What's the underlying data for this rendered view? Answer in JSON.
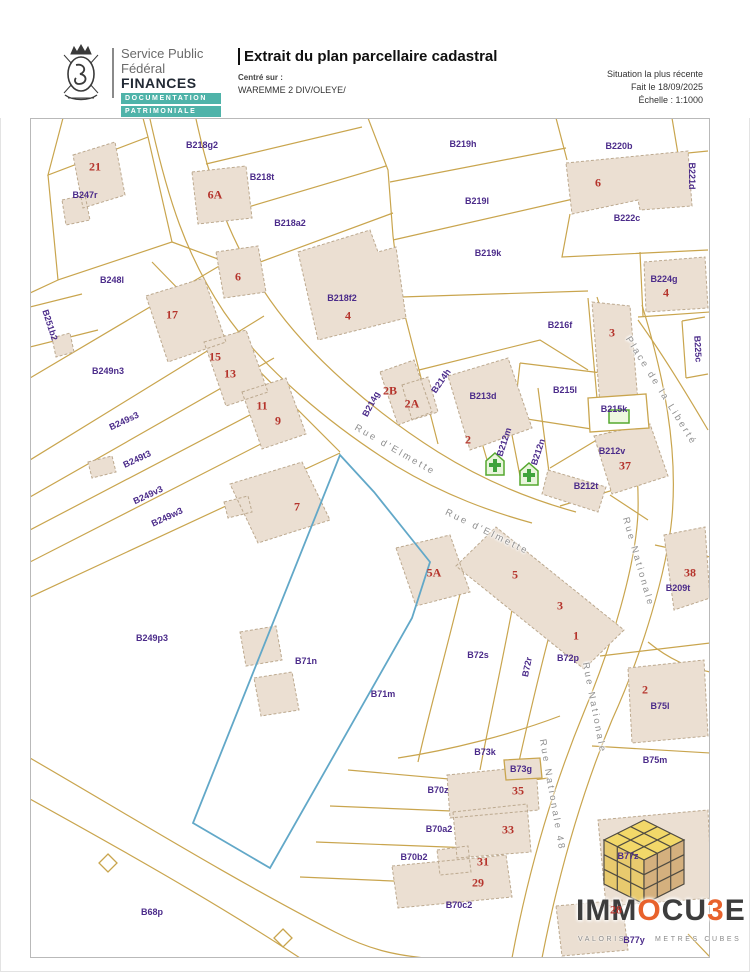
{
  "header": {
    "logo": {
      "emblem": "belgian-coat-of-arms",
      "org_line1": "Service Public",
      "org_line2": "Fédéral",
      "org_line3": "FINANCES",
      "badges": [
        "DOCUMENTATION",
        "PATRIMONIALE"
      ]
    },
    "title": "Extrait du plan parcellaire cadastral",
    "centered_label": "Centré sur :",
    "centered_value": "WAREMME 2 DIV/OLEYE/",
    "meta_lines": [
      "Situation la plus récente",
      "Fait le 18/09/2025",
      "Échelle : 1:1000"
    ]
  },
  "map": {
    "highlighted_parcel": "B71n",
    "colors": {
      "parcel_line": "#C9A54E",
      "building_fill": "#EBDFD2",
      "building_stroke": "#BCA98F",
      "parcel_label": "#4B2B8A",
      "house_number": "#B5342C",
      "street_label": "#8F8F8F",
      "highlight_line": "#62A8C8",
      "poi_green": "#3FA33C",
      "badge_teal": "#4FB3A9"
    },
    "parcel_labels": [
      {
        "text": "B247r",
        "x": 85,
        "y": 195
      },
      {
        "text": "B218g2",
        "x": 202,
        "y": 145
      },
      {
        "text": "B218t",
        "x": 262,
        "y": 177
      },
      {
        "text": "B218a2",
        "x": 290,
        "y": 223
      },
      {
        "text": "B218f2",
        "x": 342,
        "y": 298
      },
      {
        "text": "B219h",
        "x": 463,
        "y": 144
      },
      {
        "text": "B219l",
        "x": 477,
        "y": 201
      },
      {
        "text": "B219k",
        "x": 488,
        "y": 253
      },
      {
        "text": "B220b",
        "x": 619,
        "y": 146
      },
      {
        "text": "B221d",
        "x": 692,
        "y": 176,
        "rot": 90
      },
      {
        "text": "B222c",
        "x": 627,
        "y": 218
      },
      {
        "text": "B224g",
        "x": 664,
        "y": 279
      },
      {
        "text": "B225c",
        "x": 698,
        "y": 349,
        "rot": 87
      },
      {
        "text": "B248l",
        "x": 112,
        "y": 280
      },
      {
        "text": "B251b2",
        "x": 50,
        "y": 325,
        "rot": 72
      },
      {
        "text": "B249n3",
        "x": 108,
        "y": 371
      },
      {
        "text": "B249s3",
        "x": 124,
        "y": 421,
        "rot": -25
      },
      {
        "text": "B249t3",
        "x": 137,
        "y": 459,
        "rot": -25
      },
      {
        "text": "B249v3",
        "x": 148,
        "y": 495,
        "rot": -25
      },
      {
        "text": "B249w3",
        "x": 167,
        "y": 517,
        "rot": -25
      },
      {
        "text": "B249p3",
        "x": 152,
        "y": 638
      },
      {
        "text": "B216f",
        "x": 560,
        "y": 325
      },
      {
        "text": "B215l",
        "x": 565,
        "y": 390
      },
      {
        "text": "B215k",
        "x": 614,
        "y": 409
      },
      {
        "text": "B213d",
        "x": 483,
        "y": 396
      },
      {
        "text": "B214g",
        "x": 371,
        "y": 404,
        "rot": -62
      },
      {
        "text": "B214h",
        "x": 441,
        "y": 381,
        "rot": -55
      },
      {
        "text": "B212m",
        "x": 504,
        "y": 442,
        "rot": -72
      },
      {
        "text": "B212n",
        "x": 538,
        "y": 452,
        "rot": -72
      },
      {
        "text": "B212v",
        "x": 612,
        "y": 451
      },
      {
        "text": "B212t",
        "x": 586,
        "y": 486
      },
      {
        "text": "B209t",
        "x": 678,
        "y": 588
      },
      {
        "text": "B72s",
        "x": 478,
        "y": 655
      },
      {
        "text": "B72r",
        "x": 527,
        "y": 667,
        "rot": -78
      },
      {
        "text": "B72p",
        "x": 568,
        "y": 658
      },
      {
        "text": "B71n",
        "x": 306,
        "y": 661
      },
      {
        "text": "B71m",
        "x": 383,
        "y": 694
      },
      {
        "text": "B73k",
        "x": 485,
        "y": 752
      },
      {
        "text": "B73g",
        "x": 521,
        "y": 769
      },
      {
        "text": "B70z",
        "x": 438,
        "y": 790
      },
      {
        "text": "B70a2",
        "x": 439,
        "y": 829
      },
      {
        "text": "B70b2",
        "x": 414,
        "y": 857
      },
      {
        "text": "B70c2",
        "x": 459,
        "y": 905
      },
      {
        "text": "B75l",
        "x": 660,
        "y": 706
      },
      {
        "text": "B75m",
        "x": 655,
        "y": 760
      },
      {
        "text": "B68p",
        "x": 152,
        "y": 912
      },
      {
        "text": "B77z",
        "x": 628,
        "y": 856
      },
      {
        "text": "B77y",
        "x": 634,
        "y": 940
      }
    ],
    "house_numbers": [
      {
        "text": "21",
        "x": 95,
        "y": 167
      },
      {
        "text": "6A",
        "x": 215,
        "y": 195
      },
      {
        "text": "6",
        "x": 238,
        "y": 277
      },
      {
        "text": "4",
        "x": 348,
        "y": 316
      },
      {
        "text": "6",
        "x": 598,
        "y": 183
      },
      {
        "text": "4",
        "x": 666,
        "y": 293
      },
      {
        "text": "3",
        "x": 612,
        "y": 333
      },
      {
        "text": "17",
        "x": 172,
        "y": 315
      },
      {
        "text": "15",
        "x": 215,
        "y": 357
      },
      {
        "text": "13",
        "x": 230,
        "y": 374
      },
      {
        "text": "11",
        "x": 262,
        "y": 406
      },
      {
        "text": "9",
        "x": 278,
        "y": 421
      },
      {
        "text": "7",
        "x": 297,
        "y": 507
      },
      {
        "text": "2B",
        "x": 390,
        "y": 391
      },
      {
        "text": "2A",
        "x": 412,
        "y": 404
      },
      {
        "text": "2",
        "x": 468,
        "y": 440
      },
      {
        "text": "37",
        "x": 625,
        "y": 466
      },
      {
        "text": "38",
        "x": 690,
        "y": 573
      },
      {
        "text": "5A",
        "x": 434,
        "y": 573
      },
      {
        "text": "5",
        "x": 515,
        "y": 575
      },
      {
        "text": "3",
        "x": 560,
        "y": 606
      },
      {
        "text": "1",
        "x": 576,
        "y": 636
      },
      {
        "text": "2",
        "x": 645,
        "y": 690
      },
      {
        "text": "35",
        "x": 518,
        "y": 791
      },
      {
        "text": "33",
        "x": 508,
        "y": 830
      },
      {
        "text": "31",
        "x": 483,
        "y": 862
      },
      {
        "text": "29",
        "x": 478,
        "y": 883
      },
      {
        "text": "28",
        "x": 616,
        "y": 910
      }
    ],
    "street_labels": [
      {
        "text": "Rue d'Elmette",
        "x": 395,
        "y": 450,
        "rot": 30
      },
      {
        "text": "Rue d'Elmette",
        "x": 487,
        "y": 532,
        "rot": 26
      },
      {
        "text": "Place de la Liberté",
        "x": 661,
        "y": 391,
        "rot": 58
      },
      {
        "text": "Rue Nationale",
        "x": 638,
        "y": 562,
        "rot": 74
      },
      {
        "text": "Rue Nationale",
        "x": 594,
        "y": 708,
        "rot": 79
      },
      {
        "text": "Rue Nationale 48",
        "x": 552,
        "y": 795,
        "rot": 80
      }
    ],
    "poi_symbols": [
      {
        "type": "green-house-cross",
        "x": 495,
        "y": 464
      },
      {
        "type": "green-house-cross",
        "x": 529,
        "y": 474
      },
      {
        "type": "green-square",
        "x": 619,
        "y": 416
      }
    ]
  },
  "watermark": {
    "brand_parts": [
      {
        "text": "IMM",
        "color": "#3D3D3D"
      },
      {
        "text": "O",
        "color": "#E8622C"
      },
      {
        "text": "CU",
        "color": "#3D3D3D"
      },
      {
        "text": "3",
        "color": "#E8622C"
      },
      {
        "text": "E",
        "color": "#3D3D3D"
      }
    ],
    "tagline_left": "VALORIS",
    "tagline_right": "METRES CUBES"
  }
}
